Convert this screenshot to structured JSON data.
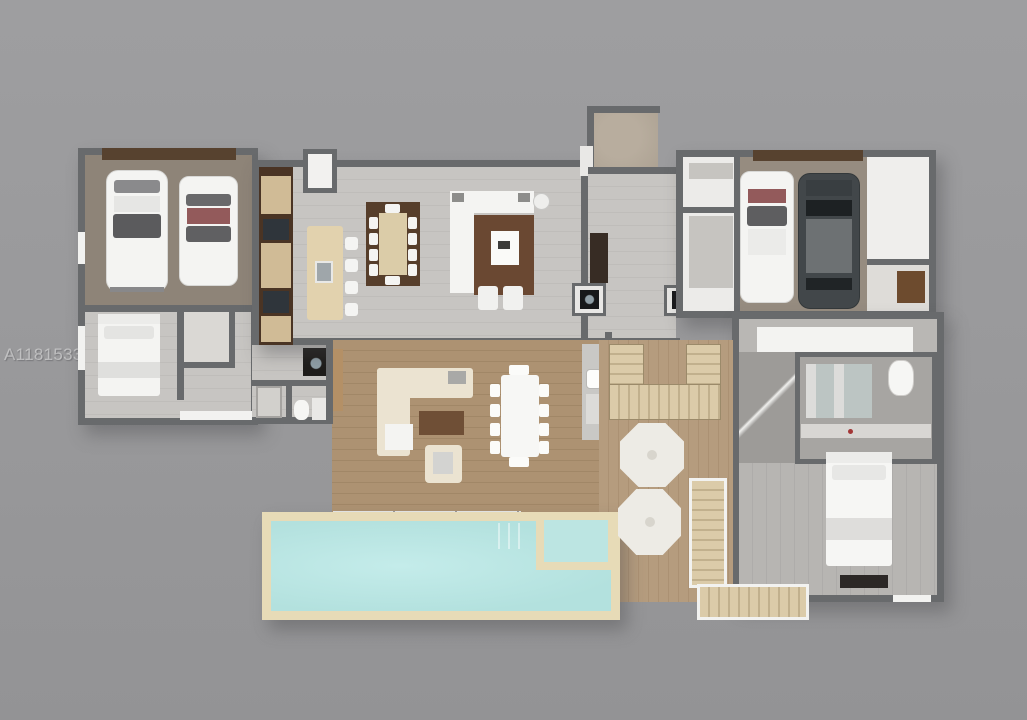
{
  "watermark": {
    "text": "A11815330 © Miami MLS® 2025"
  },
  "scene": {
    "type": "3d-floor-plan-top-view",
    "description": "Single-story home rendering with two garages, open kitchen/living area, family room, primary suite, wood deck and rectangular pool with spa",
    "rooms": [
      {
        "name": "left-garage",
        "contents": "two white cars, brown garage door"
      },
      {
        "name": "guest-bedroom",
        "contents": "double bed with white bedding, closet"
      },
      {
        "name": "guest-bathroom",
        "contents": "shower, toilet, vanity, washer"
      },
      {
        "name": "kitchen",
        "contents": "dark brown wall cabinets, beige island with sink and 4 stools"
      },
      {
        "name": "dining-area",
        "contents": "wood table with 10 white chairs on dark brown rug"
      },
      {
        "name": "living-room",
        "contents": "white L-sectional sofa, coffee table, two ottomans on brown rug"
      },
      {
        "name": "entry-porch",
        "contents": "stone landing with step and door mat"
      },
      {
        "name": "hallway",
        "contents": "dark console, two appliance niches"
      },
      {
        "name": "right-garage",
        "contents": "white car, dark SUV, storage rooms, shelf closet"
      },
      {
        "name": "primary-bathroom",
        "contents": "double vanity with mirror, shower, toilet, white counters"
      },
      {
        "name": "primary-bedroom",
        "contents": "white bed, dark media console, windows"
      },
      {
        "name": "family-room",
        "contents": "cream L-sectional, armchair, white dining table with 10 chairs, bar counter with sink"
      },
      {
        "name": "deck",
        "contents": "two white patio umbrellas, U-shaped staircase, exterior L staircase"
      },
      {
        "name": "pool-area",
        "contents": "rectangular pool with beige coping and attached square spa with steps"
      }
    ],
    "object_counts": {
      "cars": 4,
      "beds": 2,
      "sofas": 2,
      "dining_tables": 2,
      "patio_umbrellas": 2,
      "staircases": 3,
      "toilets": 3
    },
    "colors": {
      "background": "#9a9a9c",
      "walls": "#686a6c",
      "pool_water": "#b5e2df",
      "pool_coping": "#e7dbb7",
      "light_wood_floor": "#c6c4c1",
      "brown_wood_floor": "#ab9171",
      "deck_wood": "#b29979",
      "cabinet_brown": "#4a3424",
      "garage_floor": "#8e8478",
      "garage_door_brown": "#57422f",
      "furniture_white": "#f4f4f2",
      "rug_dark_brown": "#563e2b",
      "suv_dark": "#42474a",
      "accent_red": "#935a5b"
    }
  }
}
